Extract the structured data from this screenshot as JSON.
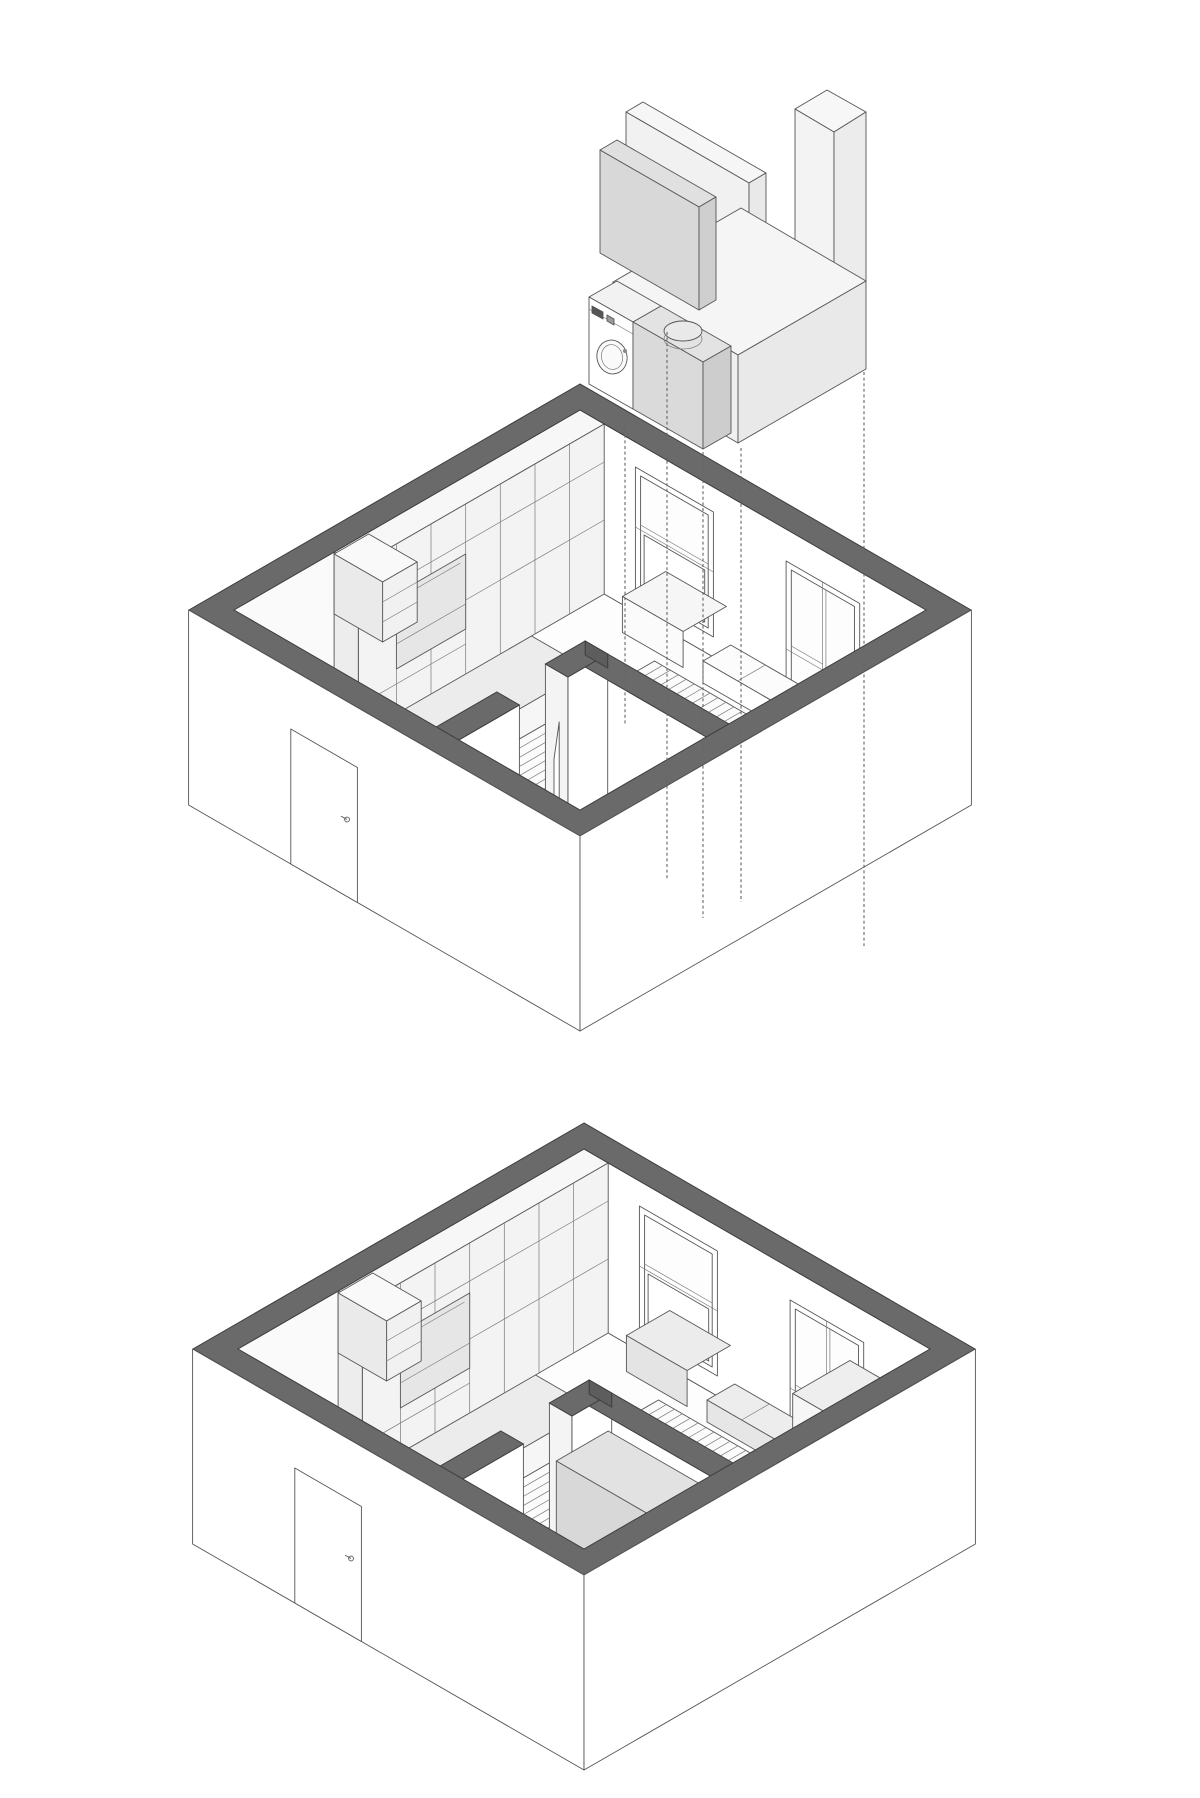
{
  "figure": {
    "title": "Micro-apartment axonometric diagrams",
    "top_label": "Exploded axonometric: furniture elements lifted above the room volume",
    "bottom_label": "Assembled axonometric: furniture elements installed in the room volume"
  },
  "palette": {
    "background": "#ffffff",
    "wall_cut_cap": "#6a6a6a",
    "line": "#555555",
    "wall_face": "#ffffff",
    "cabinet_face": "#f3f3f3",
    "platform": "#ececec",
    "niche": "#e6e6e6",
    "furniture_gray": "#d8d8d8",
    "exploded_white": "#f4f4f4"
  },
  "components": {
    "room": [
      "wall-cut-cap-ring",
      "exterior-walls",
      "entry-door",
      "cabinet-wall",
      "wall-niche",
      "open-shelf-box",
      "window-a",
      "window-b",
      "window-c",
      "under-window-box",
      "wall-bench",
      "raised-platform",
      "wood-slat-bed-base",
      "bathroom-partitions",
      "bathroom-door-leaf",
      "bathroom-floor"
    ],
    "exploded_elements": [
      "tall-wardrobe-slab",
      "gray-storage-cabinet",
      "tall-column-unit",
      "base-beam-unit",
      "washing-machine",
      "utility-box",
      "water-heater-cylinder",
      "alignment-dashed-lines"
    ],
    "installed_elements": [
      "bathroom-gray-cabinet",
      "kitchen-wall-unit",
      "gray-wall-bench",
      "gray-under-window-box"
    ]
  }
}
